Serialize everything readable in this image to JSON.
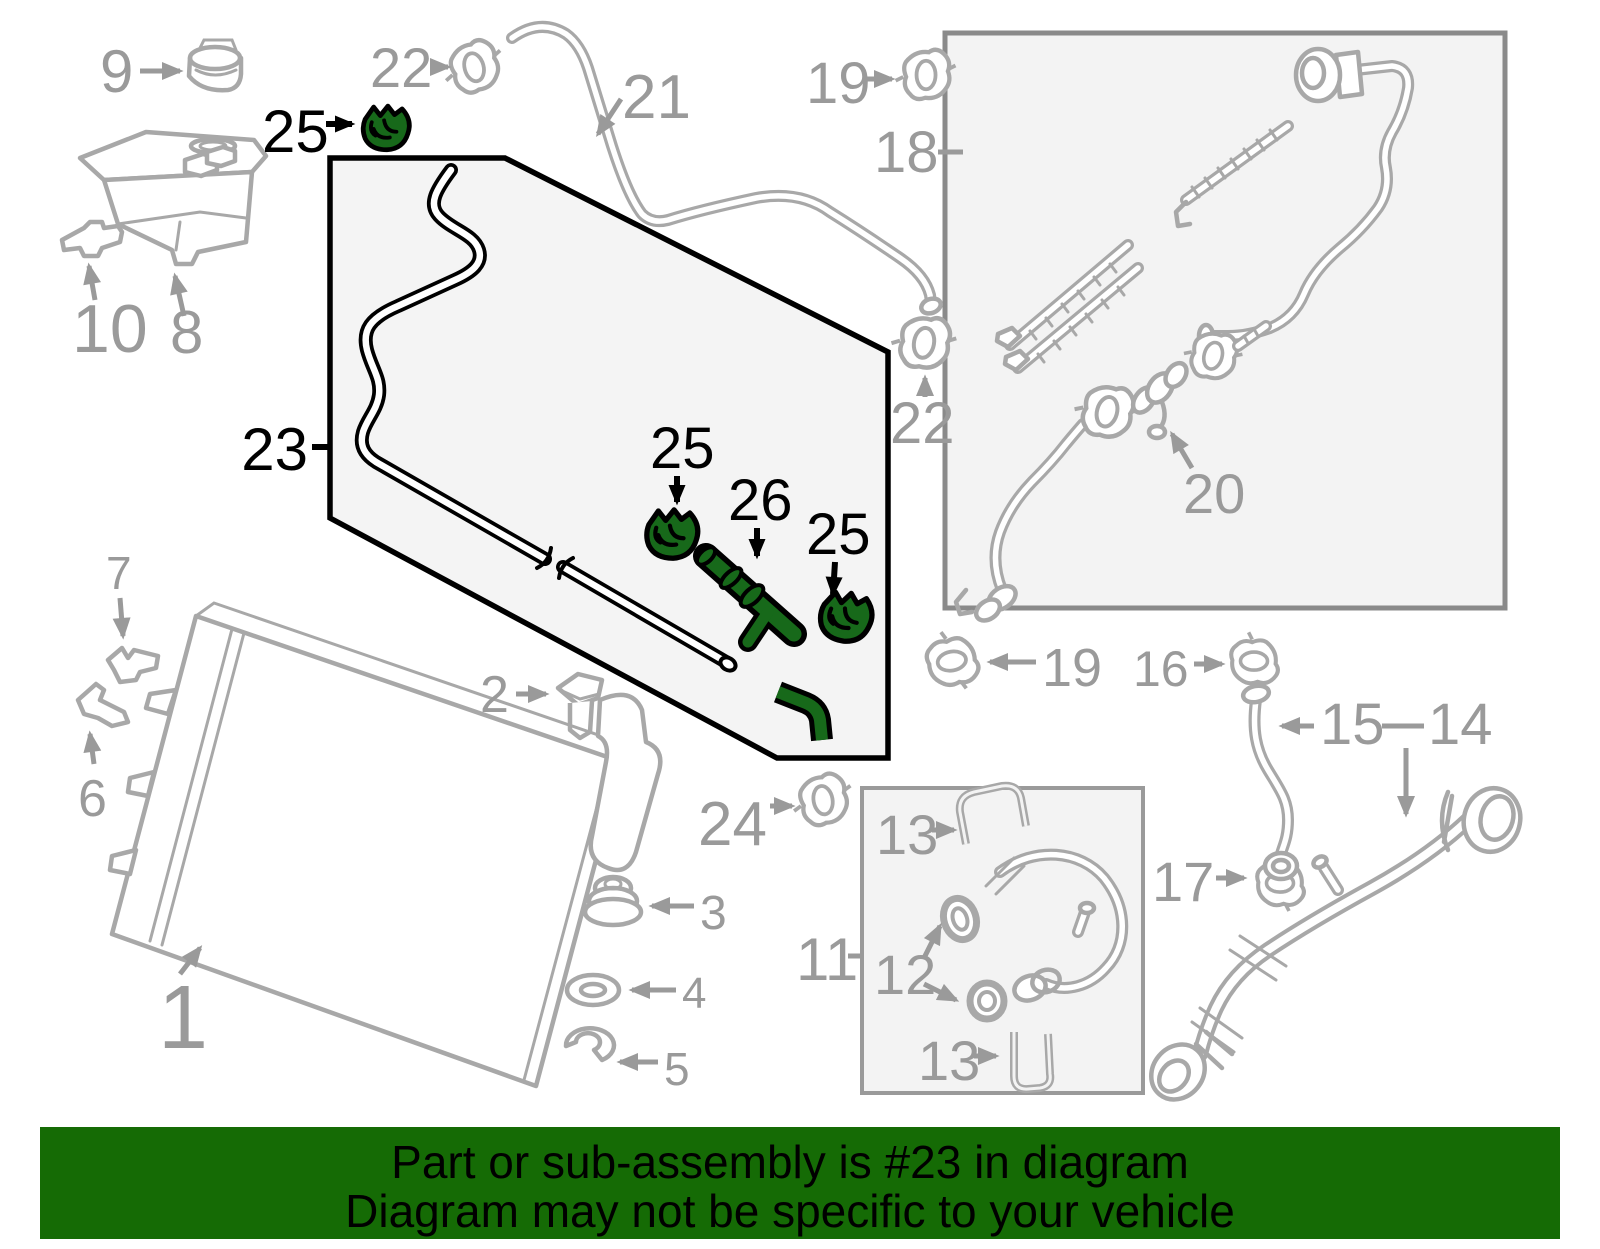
{
  "banner": {
    "line1": "Part or sub-assembly is #23 in diagram",
    "line2": "Diagram may not be specific to your vehicle"
  },
  "colors": {
    "highlight": "#17691A",
    "banner_bg": "#156B05",
    "banner_text": "#000000",
    "label_gray": "#9A9A9A",
    "part_gray": "#A8A8A8",
    "callout_black": "#000000",
    "panel_fill": "#F3F3F3"
  },
  "callouts": [
    {
      "label": "9",
      "part": "reservoir-cap"
    },
    {
      "label": "22",
      "part": "hose-clamp-top"
    },
    {
      "label": "25",
      "part": "retaining-clip-highlighted"
    },
    {
      "label": "21",
      "part": "overflow-hose"
    },
    {
      "label": "19",
      "part": "hose-clamp-top-right"
    },
    {
      "label": "18",
      "part": "hose-assembly-box"
    },
    {
      "label": "10",
      "part": "reservoir-bracket"
    },
    {
      "label": "8",
      "part": "coolant-reservoir"
    },
    {
      "label": "23",
      "part": "highlighted-hose-assembly"
    },
    {
      "label": "25",
      "part": "retaining-clip-highlighted"
    },
    {
      "label": "26",
      "part": "connector-highlighted"
    },
    {
      "label": "25",
      "part": "retaining-clip-highlighted"
    },
    {
      "label": "22",
      "part": "hose-clamp-mid"
    },
    {
      "label": "20",
      "part": "hose-assembly"
    },
    {
      "label": "2",
      "part": "plug"
    },
    {
      "label": "7",
      "part": "bracket-upper"
    },
    {
      "label": "6",
      "part": "bracket-lower"
    },
    {
      "label": "1",
      "part": "radiator"
    },
    {
      "label": "3",
      "part": "grommet"
    },
    {
      "label": "4",
      "part": "washer"
    },
    {
      "label": "5",
      "part": "retainer-clip"
    },
    {
      "label": "24",
      "part": "hose-clamp"
    },
    {
      "label": "19",
      "part": "hose-clamp-mid-right"
    },
    {
      "label": "16",
      "part": "hose-clamp-right"
    },
    {
      "label": "15",
      "part": "hose-short"
    },
    {
      "label": "14",
      "part": "radiator-hose-lower"
    },
    {
      "label": "11",
      "part": "hose-kit-box"
    },
    {
      "label": "13",
      "part": "u-clip-top"
    },
    {
      "label": "12",
      "part": "o-rings"
    },
    {
      "label": "13",
      "part": "u-clip-bottom"
    },
    {
      "label": "17",
      "part": "hose-clamp-lower-right"
    }
  ]
}
